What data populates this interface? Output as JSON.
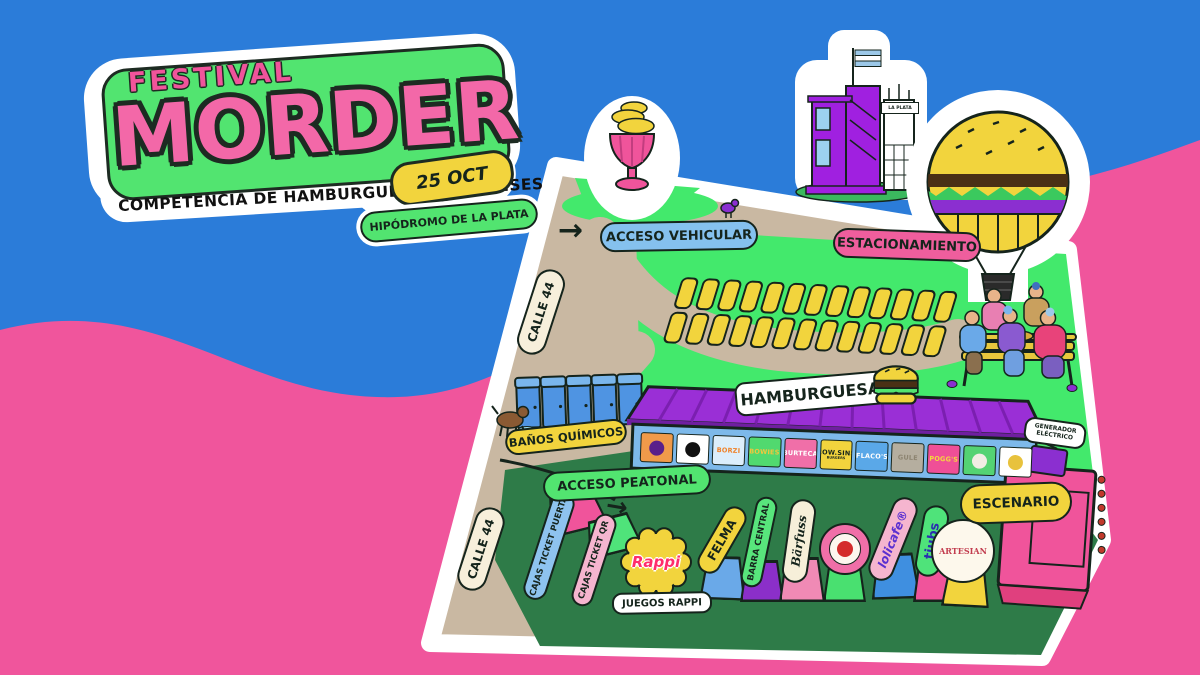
{
  "background": {
    "sky": "#2b7cd9",
    "wave": "#f0559c"
  },
  "logo": {
    "kicker": "FESTIVAL",
    "title": "MORDER",
    "date": "25 OCT",
    "subtitle": "COMPETENCIA DE HAMBURGUESAS PLATENSES",
    "venue": "HIPÓDROMO DE LA PLATA",
    "panel_green": "#52e470",
    "title_pink": "#f368a8",
    "date_yellow": "#f2d43d"
  },
  "icons": {
    "arrow_right": "→"
  },
  "map": {
    "labels": {
      "acceso_vehicular": "ACCESO VEHICULAR",
      "estacionamiento": "ESTACIONAMIENTO",
      "calle_44_top": "CALLE 44",
      "calle_44_bottom": "CALLE 44",
      "banos_quimicos": "BAÑOS QUÍMICOS",
      "hamburguesas": "HAMBURGUESAS",
      "acceso_peatonal": "ACCESO PEATONAL",
      "escenario": "ESCENARIO",
      "generador_electrico": "GENERADOR ELÉCTRICO",
      "juegos_rappi": "JUEGOS RAPPI",
      "rappi": "Rappi",
      "la_plata": "LA PLATA"
    },
    "label_colors": {
      "acceso_vehicular": "#85c1ee",
      "estacionamiento": "#ef5e9d",
      "calle_44": "#f7efdb",
      "banos_quimicos": "#f2d43d",
      "hamburguesas": "#ffffff",
      "acceso_peatonal": "#52e470",
      "escenario": "#f2d43d",
      "generador_electrico": "#ffffff",
      "juegos_rappi": "#ffffff"
    },
    "parking": {
      "rows": 2,
      "cols": 13,
      "slot_color": "#f2d43d"
    },
    "toilets_count": 5,
    "vendors": [
      {
        "label": "",
        "bg": "#f09a4a",
        "fg": "#5a1f8a",
        "logo": "purple-glyph-logo",
        "logo_color": "#5a1f8a"
      },
      {
        "label": "",
        "bg": "#ffffff",
        "fg": "#111111",
        "logo": "black-circle-logo",
        "logo_color": "#111111"
      },
      {
        "label": "BORZI",
        "bg": "#dceefb",
        "fg": "#f08127"
      },
      {
        "label": "BOWIES",
        "bg": "#51d96f",
        "fg": "#f2c63d"
      },
      {
        "label": "BURTECA",
        "bg": "#f06fa8",
        "fg": "#ffffff"
      },
      {
        "label": "COW.SINS",
        "sub": "BURGERS",
        "bg": "#f2d43d",
        "fg": "#15241c"
      },
      {
        "label": "FLACO'S",
        "bg": "#5aa8e8",
        "fg": "#ffffff"
      },
      {
        "label": "GULE",
        "bg": "#b5ae9f",
        "fg": "#8d8471"
      },
      {
        "label": "POGG'S",
        "bg": "#ef4f97",
        "fg": "#f5d93d"
      },
      {
        "label": "",
        "bg": "#54d373",
        "fg": "#ffffff",
        "logo": "white-circle-logo",
        "logo_color": "#f1ede4"
      },
      {
        "label": "",
        "bg": "#ffffff",
        "fg": "#d8a93c",
        "logo": "yellow-burger-logo",
        "logo_color": "#e8c23d"
      }
    ],
    "stalls": [
      {
        "label": "CAJAS TICKET PUERTA",
        "tag_bg": "#8ec3ef",
        "tag_fg": "#15241c",
        "stall_bg": "#f0549b"
      },
      {
        "label": "CAJAS TICKET QR",
        "tag_bg": "#f5b5cf",
        "tag_fg": "#15241c",
        "stall_bg": "#4fe37a"
      },
      {
        "label": "FELMA",
        "tag_bg": "#f2d43d",
        "tag_fg": "#15241c",
        "stall_bg": "#6aa9e8"
      },
      {
        "label": "BARRA CENTRAL",
        "tag_bg": "#58e57c",
        "tag_fg": "#15241c",
        "stall_bg": "#8b2fc9"
      },
      {
        "label": "Bärfuss",
        "tag_bg": "#f6efd9",
        "tag_fg": "#15241c",
        "stall_bg": "#f08ab5"
      },
      {
        "label": "",
        "tag_bg": "#f06fa8",
        "tag_fg": "#15241c",
        "stall_bg": "#49e070",
        "logo": "round-striped-badge"
      },
      {
        "label": "lolicafe®",
        "tag_bg": "#f5b5cf",
        "tag_fg": "#5a2fd0",
        "stall_bg": "#3f8fe0"
      },
      {
        "label": "tjubs",
        "tag_bg": "#4fe37a",
        "tag_fg": "#2a2fb0",
        "stall_bg": "#f0549b"
      },
      {
        "label": "ARTESIAN",
        "tag_bg": "#fdf8ec",
        "tag_fg": "#c23d4f",
        "stall_bg": "#f2d43d"
      }
    ],
    "illustrations": {
      "balloon": "hamburger-hot-air-balloon",
      "building": "grandstand-with-argentine-flag",
      "tower": "la-plata-tower",
      "trophy": "trophy-cup-with-burgers",
      "toilets": "portable-toilets",
      "dog": "dog",
      "bench": "people-eating-burgers-on-bench",
      "pigeons": "pigeons",
      "burger": "burger-icon",
      "stage": "stage-structure",
      "tent": "vendor-tent-purple-awning"
    }
  }
}
